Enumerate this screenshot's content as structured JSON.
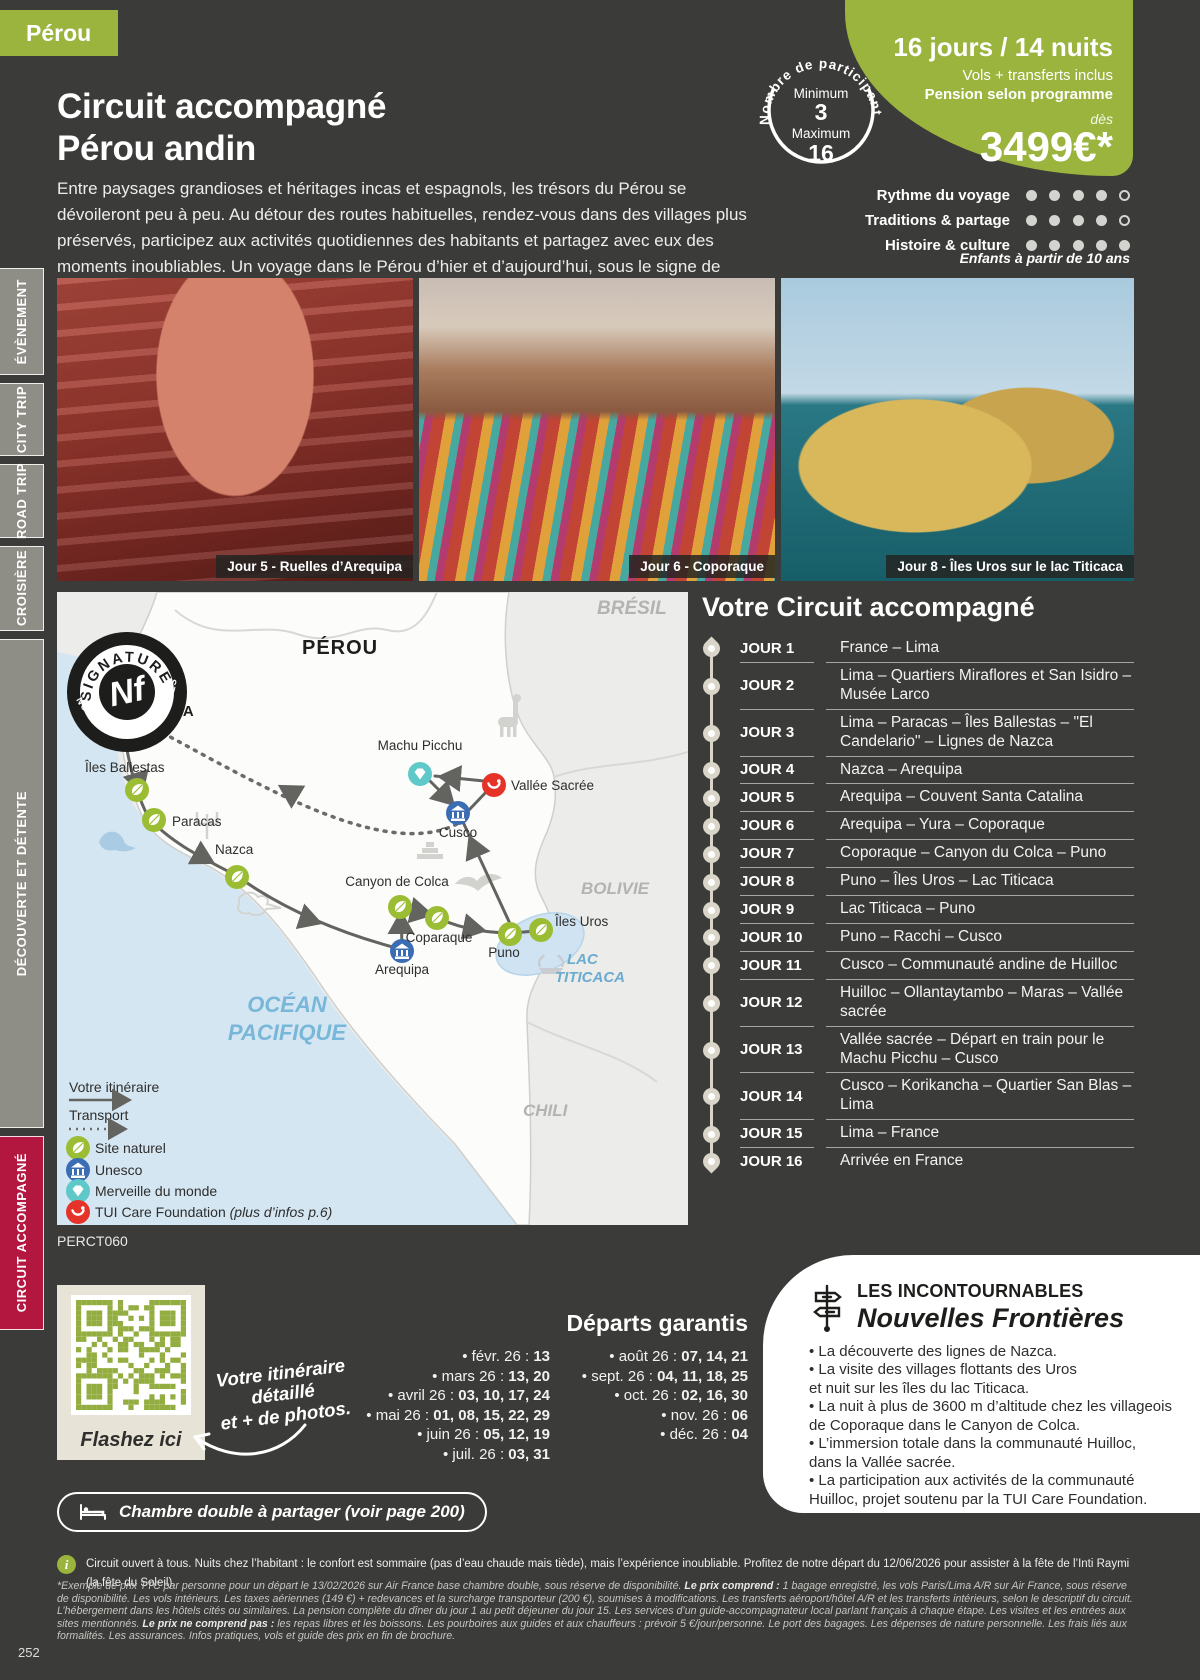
{
  "colors": {
    "background": "#3b3b39",
    "accent_green": "#9ab43e",
    "active_tab_red": "#b3163f",
    "leaf_green": "#9bbd33",
    "unesco_blue": "#3a6db3",
    "wonder_teal": "#5fc9c9",
    "tui_red": "#e5332a",
    "map_ocean": "#d5e6f3",
    "map_land": "#fcfcfb"
  },
  "header": {
    "country_tag": "Pérou",
    "title_line1": "Circuit accompagné",
    "title_line2": "Pérou andin",
    "description": "Entre paysages grandioses et héritages incas et espagnols, les trésors du Pérou se dévoileront peu à peu. Au détour des routes habituelles, rendez-vous dans des villages plus préservés, participez aux activités quotidiennes des habitants et partagez avec eux des moments inoubliables. Un voyage dans le Pérou d’hier et d’aujourd’hui, sous le signe de l’authenticité."
  },
  "offer": {
    "duration": "16 jours / 14 nuits",
    "flights": "Vols + transferts inclus",
    "board": "Pension selon programme",
    "from_label": "dès",
    "price": "3499€*",
    "participants": {
      "title": "Nombre de participants",
      "min_label": "Minimum",
      "min": "3",
      "max_label": "Maximum",
      "max": "16"
    },
    "ratings": [
      {
        "label": "Rythme du voyage",
        "value": 4,
        "max": 5
      },
      {
        "label": "Traditions & partage",
        "value": 4,
        "max": 5
      },
      {
        "label": "Histoire & culture",
        "value": 5,
        "max": 5
      }
    ],
    "children_note": "Enfants à partir de 10 ans"
  },
  "sidebar": {
    "items": [
      {
        "label": "ÉVÈNEMENT",
        "active": false
      },
      {
        "label": "CITY TRIP",
        "active": false
      },
      {
        "label": "ROAD TRIP",
        "active": false
      },
      {
        "label": "CROISIÈRE",
        "active": false
      },
      {
        "label": "DÉCOUVERTE ET DÉTENTE",
        "active": false
      },
      {
        "label": "CIRCUIT ACCOMPAGNÉ",
        "active": true
      }
    ]
  },
  "photos": [
    {
      "caption": "Jour 5 - Ruelles d’Arequipa"
    },
    {
      "caption": "Jour 6 - Coporaque"
    },
    {
      "caption": "Jour 8 - Îles Uros sur le lac Titicaca"
    }
  ],
  "map": {
    "badge": {
      "top": "SIGNATURE",
      "bottom": "NOUVELLES FRONTIÈRES",
      "monogram": "Nf"
    },
    "country": "PÉROU",
    "neighbors": {
      "brazil": "BRÉSIL",
      "bolivia": "BOLIVIE",
      "chile": "CHILI"
    },
    "ocean_line1": "OCÉAN",
    "ocean_line2": "PACIFIQUE",
    "lake_line1": "LAC",
    "lake_line2": "TITICACA",
    "plane_glyph": "✈",
    "stations": {
      "lima": "LIMA",
      "iles_ballestas": "Îles Ballestas",
      "paracas": "Paracas",
      "nazca": "Nazca",
      "machu_picchu": "Machu Picchu",
      "vallee_sacree": "Vallée Sacrée",
      "cusco": "Cusco",
      "canyon_colca": "Canyon de Colca",
      "coparaque": "Coparaque",
      "arequipa": "Arequipa",
      "puno": "Puno",
      "iles_uros": "Îles Uros"
    },
    "legend": {
      "itinerary": "Votre itinéraire",
      "transport": "Transport",
      "site_naturel": "Site naturel",
      "unesco": "Unesco",
      "merveille": "Merveille du monde",
      "tui_care": "TUI Care Foundation",
      "tui_care_note": "(plus d’infos p.6)"
    }
  },
  "product_code": "PERCT060",
  "itinerary": {
    "title": "Votre Circuit accompagné",
    "days": [
      {
        "label": "JOUR 1",
        "text": "France – Lima"
      },
      {
        "label": "JOUR 2",
        "text": "Lima – Quartiers Miraflores et San Isidro – Musée Larco"
      },
      {
        "label": "JOUR 3",
        "text": "Lima – Paracas – Îles Ballestas – \"El Candelario\" – Lignes de Nazca"
      },
      {
        "label": "JOUR 4",
        "text": "Nazca – Arequipa"
      },
      {
        "label": "JOUR 5",
        "text": "Arequipa – Couvent Santa Catalina"
      },
      {
        "label": "JOUR 6",
        "text": "Arequipa – Yura – Coporaque"
      },
      {
        "label": "JOUR 7",
        "text": "Coporaque – Canyon du Colca – Puno"
      },
      {
        "label": "JOUR 8",
        "text": "Puno – Îles Uros – Lac Titicaca"
      },
      {
        "label": "JOUR 9",
        "text": "Lac Titicaca – Puno"
      },
      {
        "label": "JOUR 10",
        "text": "Puno – Racchi – Cusco"
      },
      {
        "label": "JOUR 11",
        "text": "Cusco – Communauté andine de Huilloc"
      },
      {
        "label": "JOUR 12",
        "text": "Huilloc – Ollantaytambo – Maras – Vallée sacrée"
      },
      {
        "label": "JOUR 13",
        "text": "Vallée sacrée – Départ en train pour le Machu Picchu – Cusco"
      },
      {
        "label": "JOUR 14",
        "text": "Cusco – Korikancha – Quartier San Blas – Lima"
      },
      {
        "label": "JOUR 15",
        "text": "Lima – France"
      },
      {
        "label": "JOUR 16",
        "text": "Arrivée en France"
      }
    ]
  },
  "qr": {
    "flash_label": "Flashez ici",
    "note": "Votre itinéraire\ndétaillé\net + de photos."
  },
  "departures": {
    "title": "Départs garantis",
    "col1": [
      {
        "month": "févr. 26",
        "days": "13"
      },
      {
        "month": "mars 26",
        "days": "13, 20"
      },
      {
        "month": "avril 26",
        "days": "03, 10, 17, 24"
      },
      {
        "month": "mai 26",
        "days": "01, 08, 15, 22, 29"
      },
      {
        "month": "juin 26",
        "days": "05, 12, 19"
      },
      {
        "month": "juil. 26",
        "days": "03, 31"
      }
    ],
    "col2": [
      {
        "month": "août 26",
        "days": "07, 14, 21"
      },
      {
        "month": "sept. 26",
        "days": "04, 11, 18, 25"
      },
      {
        "month": "oct. 26",
        "days": "02, 16, 30"
      },
      {
        "month": "nov. 26",
        "days": "06"
      },
      {
        "month": "déc. 26",
        "days": "04"
      }
    ]
  },
  "highlights": {
    "kicker": "LES INCONTOURNABLES",
    "brand": "Nouvelles Frontières",
    "items": [
      "La découverte des lignes de Nazca.",
      "La visite des villages flottants des Uros\net nuit sur les îles du lac Titicaca.",
      "La nuit à plus de 3600 m d’altitude chez les villageois\nde Coporaque dans le Canyon de Colca.",
      "L’immersion totale dans la communauté Huilloc,\ndans la Vallée sacrée.",
      "La participation aux activités de la communauté\nHuilloc, projet soutenu par la TUI Care Foundation."
    ]
  },
  "room_note": "Chambre double à partager (voir page 200)",
  "footer": {
    "info": "Circuit ouvert à tous. Nuits chez l’habitant : le confort est sommaire (pas d’eau chaude mais tiède), mais l’expérience inoubliable. Profitez de notre départ du 12/06/2026 pour assister à la fête de l’Inti Raymi (la fête du Soleil).",
    "legal": [
      {
        "bold": false,
        "text": "*Exemple de prix TTC par personne pour un départ le 13/02/2026 sur Air France base chambre double, sous réserve de disponibilité. "
      },
      {
        "bold": true,
        "text": "Le prix comprend : "
      },
      {
        "bold": false,
        "text": "1 bagage enregistré, les vols Paris/Lima A/R sur Air France, sous réserve de disponibilité. Les vols intérieurs. Les taxes aériennes (149 €) + redevances et la surcharge transporteur (200 €), soumises à modifications. Les transferts aéroport/hôtel A/R et les transferts intérieurs, selon le descriptif du circuit. L’hébergement dans les hôtels cités ou similaires. La pension complète du dîner du jour 1 au petit déjeuner du jour 15. Les services d’un guide-accompagnateur local parlant français à chaque étape. Les visites et les entrées aux sites mentionnés. "
      },
      {
        "bold": true,
        "text": "Le prix ne comprend pas : "
      },
      {
        "bold": false,
        "text": "les repas libres et les boissons. Les pourboires aux guides et aux chauffeurs : prévoir 5 €/jour/personne. Le port des bagages. Les dépenses de nature personnelle. Les frais liés aux formalités. Les assurances. Infos pratiques, vols et guide des prix en fin de brochure."
      }
    ],
    "page_number": "252"
  }
}
